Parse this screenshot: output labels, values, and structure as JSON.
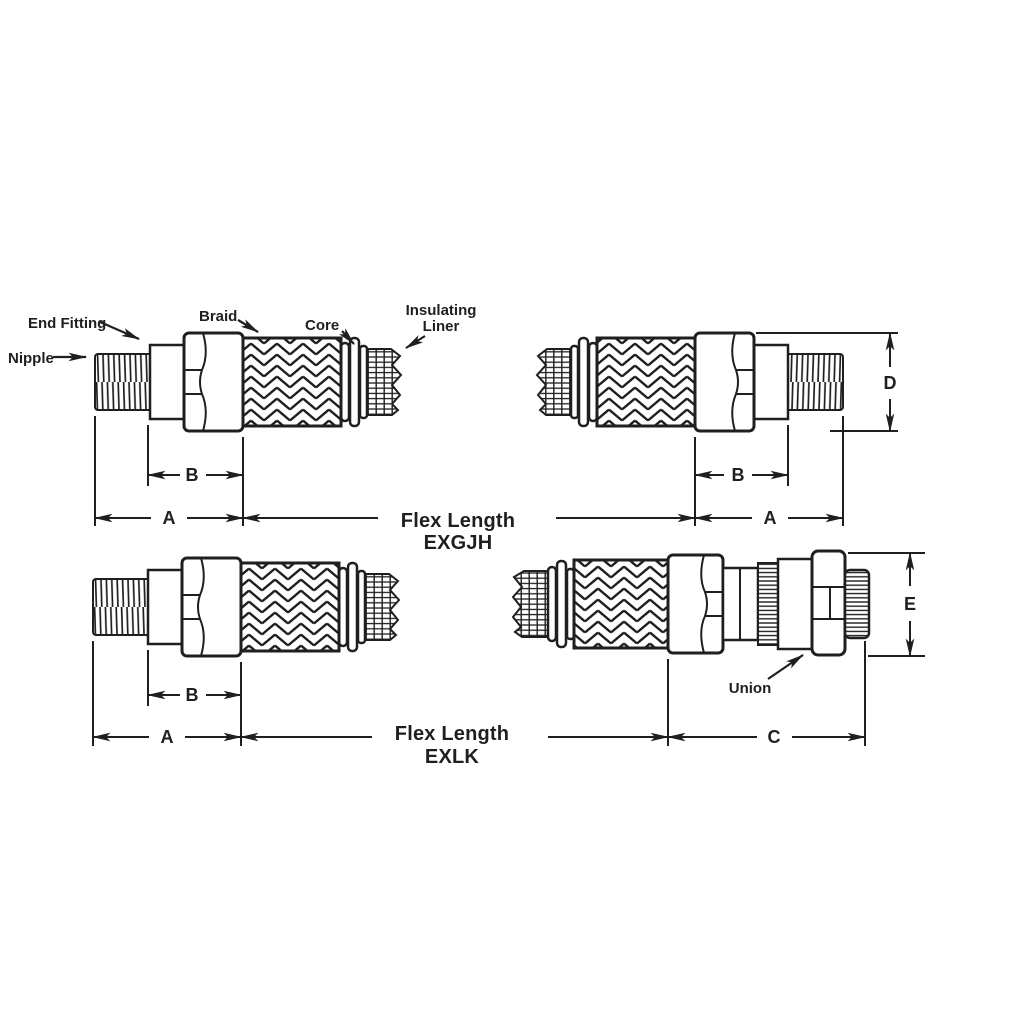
{
  "drawing": {
    "background": "#ffffff",
    "ink": "#1f1f1f",
    "callouts": {
      "end_fitting": "End Fitting",
      "nipple": "Nipple",
      "braid": "Braid",
      "core": "Core",
      "insulating_liner_line1": "Insulating",
      "insulating_liner_line2": "Liner",
      "union": "Union"
    },
    "dimensions": {
      "a": "A",
      "b": "B",
      "c": "C",
      "d": "D",
      "e": "E"
    },
    "figures": {
      "exgjh": {
        "flex_label": "Flex Length",
        "model": "EXGJH"
      },
      "exlk": {
        "flex_label": "Flex Length",
        "model": "EXLK"
      }
    }
  }
}
